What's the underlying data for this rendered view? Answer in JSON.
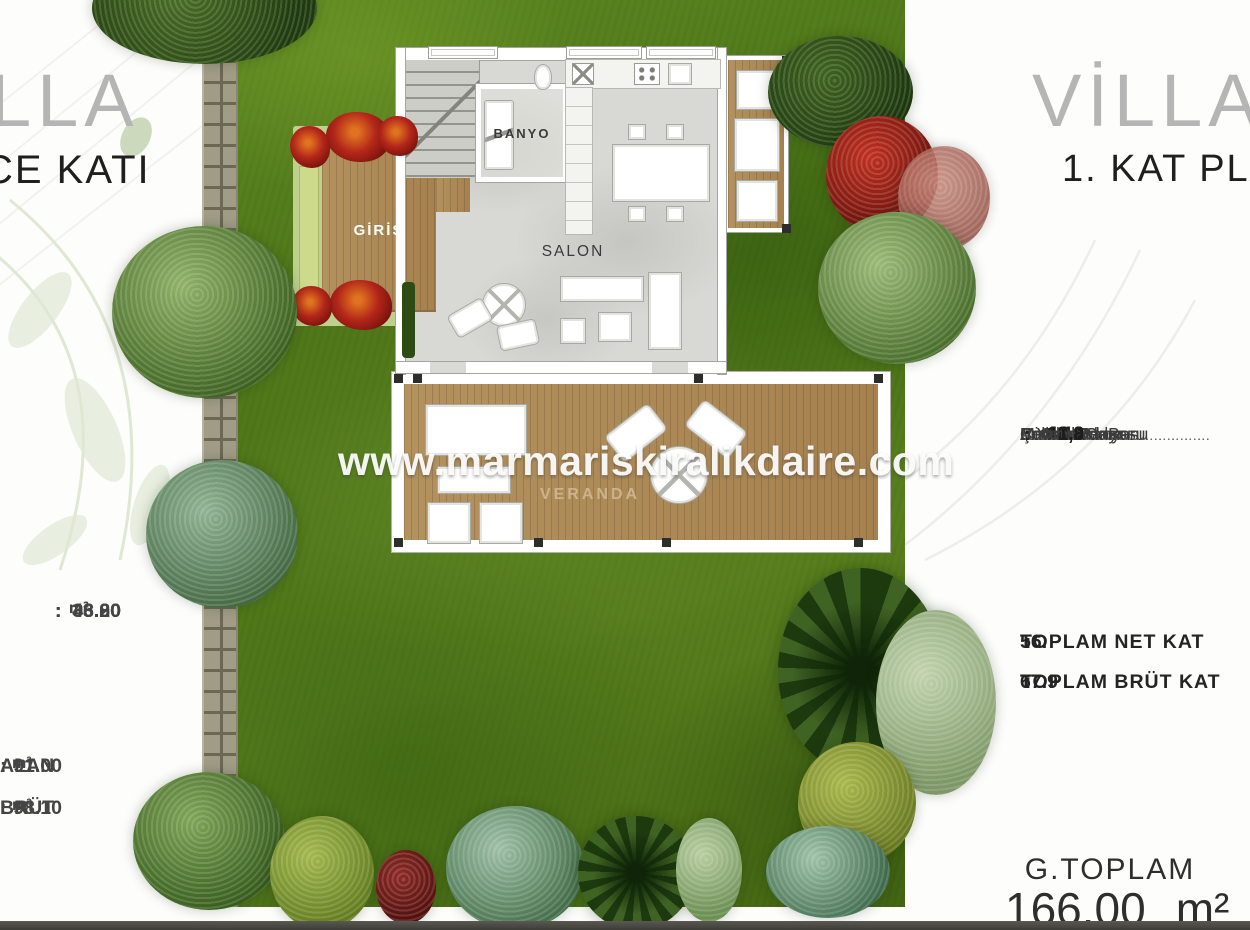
{
  "watermark": {
    "text": "www.marmariskiralikdaire.com"
  },
  "colon_char": ":",
  "leader_dots": "...........................................",
  "plan_labels": {
    "banyo": "BANYO",
    "salon": "SALON",
    "giris": "GİRİŞ",
    "veranda": "VERANDA"
  },
  "left_panel": {
    "title_partial": "LLA",
    "subtitle_partial": "CE KATI",
    "measurements": [
      {
        "value": "38.00",
        "unit": "m²"
      },
      {
        "value": "3.80",
        "unit": "m²"
      },
      {
        "value": "46.00",
        "unit": "m²"
      },
      {
        "value": "3.20",
        "unit": "m²"
      }
    ],
    "totals": [
      {
        "label": "ALAN",
        "value": "91.00",
        "unit": "m²"
      },
      {
        "label": "BRÜT",
        "value": "98.10",
        "unit": "m²"
      }
    ]
  },
  "right_panel": {
    "title": "VİLLA",
    "subtitle": "1. KAT PLA",
    "rooms": [
      {
        "label": "Antre",
        "value": "4.10"
      },
      {
        "label": "Misafir Odası",
        "value": "11.3"
      },
      {
        "label": "M.Oda Banyosu",
        "value": "3.1"
      },
      {
        "label": "Çocuk Odası",
        "value": "12.0"
      },
      {
        "label": "Ç. Oda Banyosu",
        "value": "3,2"
      },
      {
        "label": "E.Yatak Odası",
        "value": "14.0"
      },
      {
        "label": "E.Yatak O. Ban",
        "value": "3,1"
      },
      {
        "label": "Balkon",
        "value": "3.8"
      },
      {
        "label": "Merdiven",
        "value": "1.8"
      }
    ],
    "totals": [
      {
        "label": "TOPLAM NET KAT",
        "value": "56."
      },
      {
        "label": "TOPLAM BRÜT KAT",
        "value": "67.9"
      }
    ],
    "grand_total": {
      "label": "G.TOPLAM",
      "value": "166.00",
      "unit": "m²"
    }
  },
  "colors": {
    "grass_green": "#4f7717",
    "deck_wood": "#ab8a5c",
    "red_tree": "#a31410",
    "flower_red": "#b3261a",
    "title_gray": "#b5b5b5",
    "text_dark": "#1f1f1f",
    "footer_bar": "#4b4a45"
  }
}
